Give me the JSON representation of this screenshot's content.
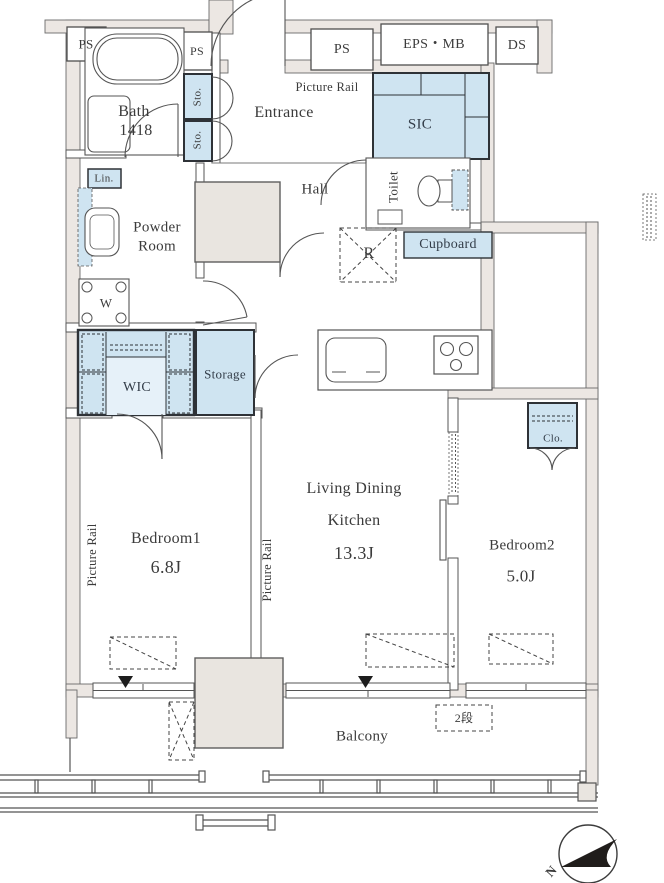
{
  "rooms": {
    "bath": {
      "name": "Bath",
      "size": "1418"
    },
    "entrance": {
      "name": "Entrance"
    },
    "hall": {
      "name": "Hall"
    },
    "toilet": {
      "name": "Toilet"
    },
    "sic": {
      "name": "SIC"
    },
    "powder_room": {
      "line1": "Powder",
      "line2": "Room"
    },
    "wic": {
      "name": "WIC"
    },
    "storage": {
      "name": "Storage"
    },
    "bedroom1": {
      "name": "Bedroom1",
      "area": "6.8J"
    },
    "living_dining_kitchen": {
      "line1": "Living Dining",
      "line2": "Kitchen",
      "area": "13.3J"
    },
    "bedroom2": {
      "name": "Bedroom2",
      "area": "5.0J"
    },
    "balcony": {
      "name": "Balcony"
    }
  },
  "labels": {
    "ps_top_left": "PS",
    "ps_bath": "PS",
    "ps_corridor": "PS",
    "eps_mb": "EPS・MB",
    "ds": "DS",
    "sto_upper": "Sto.",
    "sto_lower": "Sto.",
    "lin": "Lin.",
    "washer": "W",
    "refrigerator": "R",
    "cupboard": "Cupboard",
    "closet": "Clo.",
    "picture_rail_entrance": "Picture Rail",
    "picture_rail_bedroom1": "Picture Rail",
    "picture_rail_ldk": "Picture Rail",
    "two_tier_note": "2段",
    "compass_north": "N"
  },
  "colors": {
    "wall_fill": "#ece7e3",
    "closet_fill": "#cfe4f1",
    "column_fill": "#e9e5e0",
    "line": "#555555",
    "text": "#3b3b3b"
  }
}
